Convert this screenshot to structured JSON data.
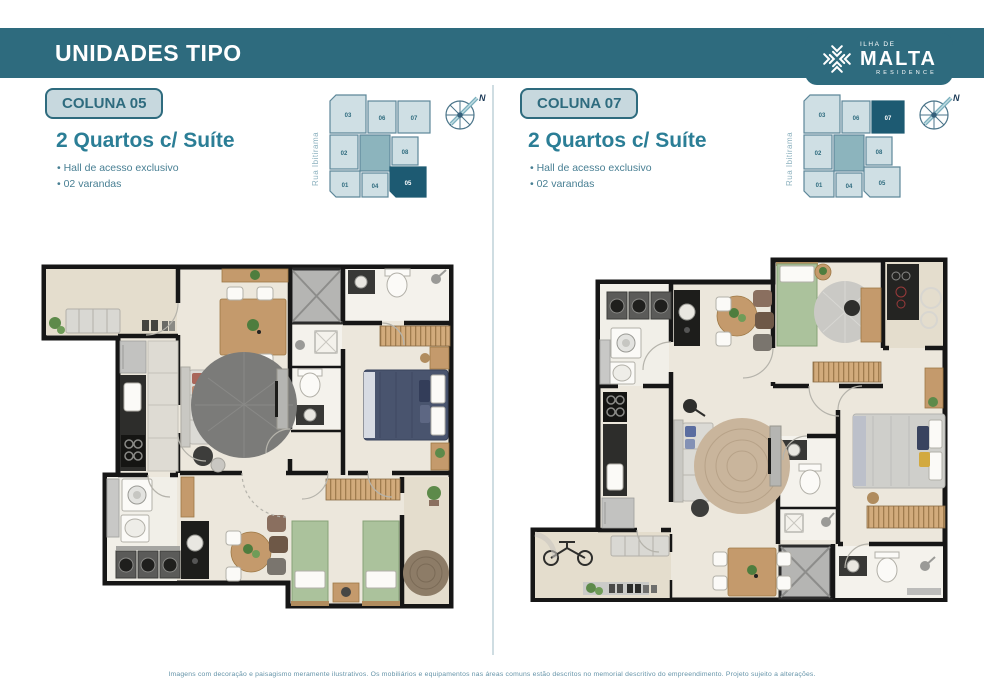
{
  "header": {
    "title": "UNIDADES TIPO"
  },
  "logo": {
    "top": "ILHA DE",
    "name": "MALTA",
    "sub": "RESIDENCE"
  },
  "columns": [
    {
      "badge": "COLUNA 05",
      "title": "2 Quartos c/ Suíte",
      "bullets": [
        "Hall de acesso exclusivo",
        "02 varandas"
      ],
      "street": "Rua Ibitirama",
      "compass": "N",
      "highlight": "05",
      "keyplan_units": {
        "u01": "01",
        "u02": "02",
        "u03": "03",
        "u04": "04",
        "u05": "05",
        "u06": "06",
        "u07": "07",
        "u08": "08"
      }
    },
    {
      "badge": "COLUNA 07",
      "title": "2 Quartos c/ Suíte",
      "bullets": [
        "Hall de acesso exclusivo",
        "02 varandas"
      ],
      "street": "Rua Ibitirama",
      "compass": "N",
      "highlight": "07",
      "keyplan_units": {
        "u01": "01",
        "u02": "02",
        "u03": "03",
        "u04": "04",
        "u05": "05",
        "u06": "06",
        "u07": "07",
        "u08": "08"
      }
    }
  ],
  "footer": {
    "disclaimer": "Imagens com decoração e paisagismo meramente ilustrativos. Os mobiliários e equipamentos nas áreas comuns estão descritos no memorial descritivo do empreendimento. Projeto sujeito a alterações."
  },
  "colors": {
    "teal": "#2e6b7e",
    "badge_bg": "#c7d8de",
    "accent": "#2b7e96",
    "keyplan_highlight": "#1d5a72"
  }
}
